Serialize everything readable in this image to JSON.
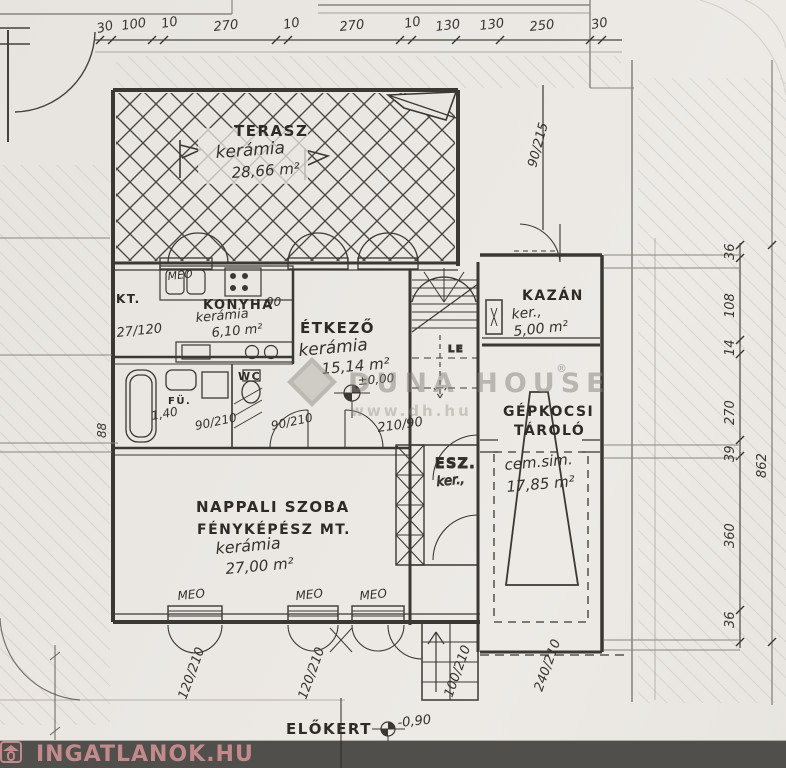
{
  "watermark": {
    "brand": "DUNA HOUSE",
    "reg": "®",
    "url": "www.dh.hu"
  },
  "footer": {
    "brand": "INGATLANOK.HU"
  },
  "window_tag": "MEO",
  "stair_label": "LE",
  "rooms": {
    "terasz": {
      "name": "TERASZ",
      "material": "kerámia",
      "area": "28,66 m²"
    },
    "konyha": {
      "abbr": "KT.",
      "name": "KONYHA",
      "material": "kerámia",
      "area": "6,10 m²"
    },
    "etkezo": {
      "name": "ÉTKEZŐ",
      "material": "kerámia",
      "area": "15,14 m²",
      "level": "±0,00"
    },
    "kazan": {
      "name": "KAZÁN",
      "material": "ker.,",
      "area": "5,00 m²"
    },
    "garazs": {
      "name_line1": "GÉPKOCSI",
      "name_line2": "TÁROLÓ",
      "material": "cem.sim.",
      "area": "17,85 m²"
    },
    "nappali": {
      "name_line1": "NAPPALI SZOBA",
      "name_line2": "FÉNYKÉPÉSZ MT.",
      "material": "kerámia",
      "area": "27,00 m²"
    },
    "esz": {
      "name": "ESZ.",
      "material": "ker.,"
    },
    "furdo": {
      "label": "FÜ.",
      "wc": "WC"
    },
    "elokert": {
      "name": "ELŐKERT",
      "level": "-0,90"
    }
  },
  "dims": {
    "top": [
      "30",
      "100",
      "10",
      "270",
      "10",
      "270",
      "10",
      "130",
      "130",
      "250",
      "30"
    ],
    "right": [
      "36",
      "108",
      "14",
      "270",
      "39",
      "862",
      "360",
      "36"
    ],
    "door_right": "90/215",
    "window1": "120/210",
    "window2": "120/210",
    "window3": "100/210",
    "garage_door": "240/210",
    "kitchen": "27/120",
    "bath_a": "1,40",
    "bath_b": "90/210",
    "bath_c": "90/210",
    "etkezo_door": "210/90",
    "konyha_door": "90",
    "wall_mark": "88"
  },
  "colors": {
    "ink": "#3b3833",
    "pencil": "#c7c2ba",
    "footer_bar": "#514f4c",
    "logo": "#c28a8b"
  }
}
